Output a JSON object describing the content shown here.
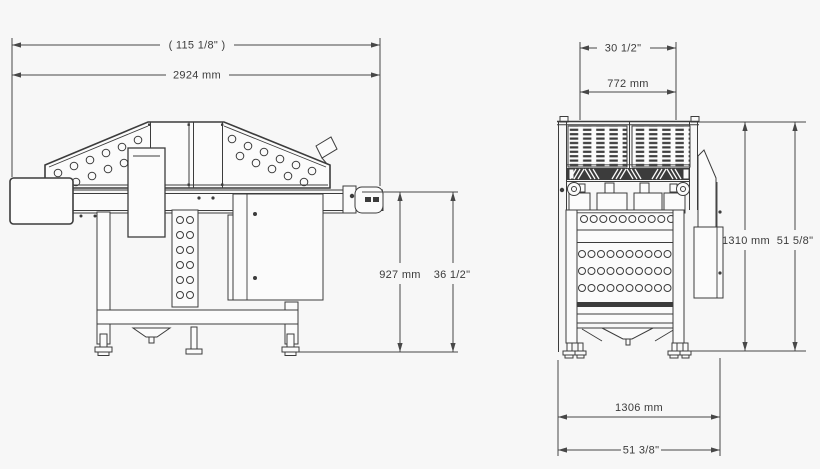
{
  "drawing": {
    "kind": "technical-dimension-drawing",
    "background": "#f7f7f7",
    "line_color": "#3c3c3c",
    "views": [
      "side-elevation",
      "end-elevation"
    ]
  },
  "side_view": {
    "dims": {
      "overall_in": "( 115 1/8\" )",
      "overall_mm": "2924 mm",
      "height_mm": "927 mm",
      "height_in": "36 1/2\""
    }
  },
  "front_view": {
    "dims": {
      "hopper_in": "30 1/2\"",
      "hopper_mm": "772 mm",
      "height_mm": "1310 mm",
      "height_in": "51 5/8\"",
      "base_mm": "1306 mm",
      "base_in": "51 3/8\""
    }
  }
}
